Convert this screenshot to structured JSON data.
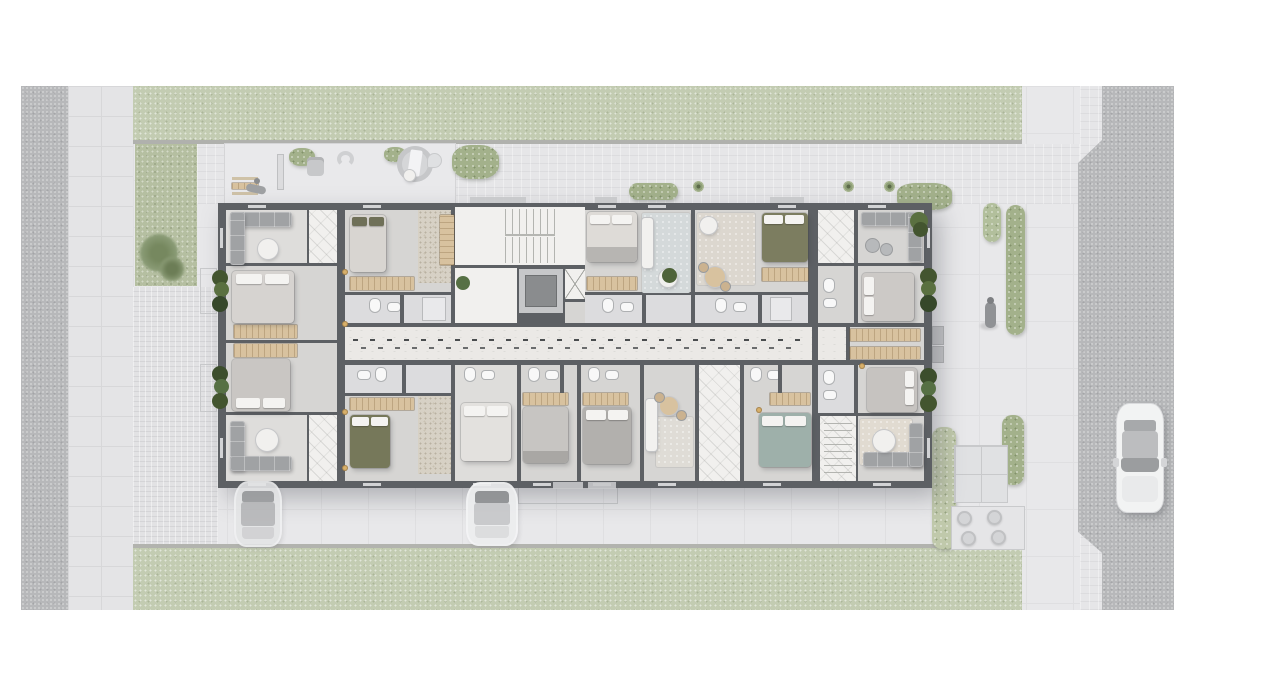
{
  "scene": {
    "type": "architectural site / floor plan rendering",
    "view": "top-down",
    "content": "residential apartment building ground floor with central corridor, stair core, elevator, furnished units, surrounding pavement, lawns, hedges, roads and cars",
    "visible_text": ""
  },
  "palette": {
    "background": "#ffffff",
    "road": "#b7b8ba",
    "sidewalk": "#e4e4e6",
    "pavement": "#e8e8ea",
    "grass": "#c3ccb2",
    "garden_square": "#b5bfa1",
    "hedge": "#a3b18b",
    "building_wall": "#5d6064",
    "unit_floor": "#d6d5d3",
    "hall_floor": "#f1f0ee",
    "corridor_floor": "#ebe9e6",
    "bathroom_floor": "#dcdcde",
    "wood_furniture": "#d8c29f",
    "sofa_gray": "#a0a2a4",
    "bed_olive": "#7c7d60",
    "bed_teal": "#9eb0aa",
    "elevator_cab": "#8a8c8e",
    "car_body": "#f2f3f3"
  },
  "inventory": {
    "roads": [
      "left-vertical-road",
      "right-vertical-road"
    ],
    "grass_strips": [
      "top-lawn",
      "bottom-lawn",
      "garden-square"
    ],
    "cars": [
      "ghost-car-driveway-left",
      "ghost-car-driveway-center",
      "white-car-right-road"
    ],
    "people": [
      "person-on-patio",
      "person-on-walkway"
    ],
    "circulation": [
      "central-staircase",
      "elevator",
      "central-corridor-with-dashed-guideline"
    ],
    "beds": 12,
    "corner_sofas": 4,
    "dining_sets": 2,
    "outdoor_patios": [
      "top-left-furnished-patio",
      "bottom-right-patio-with-planters"
    ]
  }
}
